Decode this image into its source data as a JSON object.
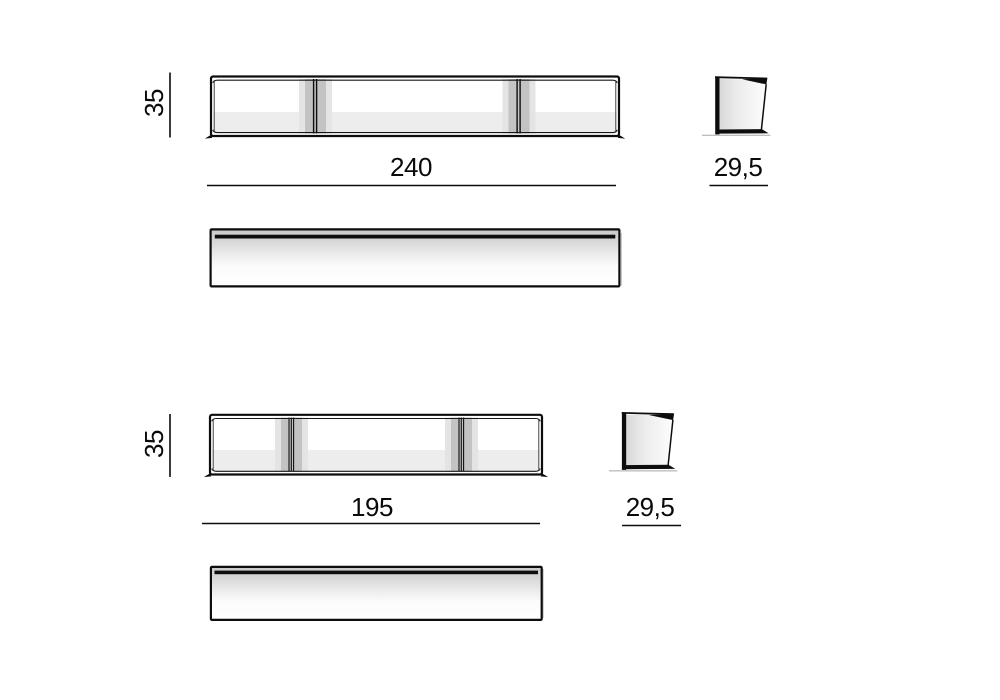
{
  "colors": {
    "background": "#ffffff",
    "line": "#0d0d0d",
    "interior_shade": "#ededed",
    "divider_light": "#e4e4e4",
    "divider_medium": "#c3c3c3"
  },
  "diagram": {
    "type": "furniture-dimension-drawing",
    "items": [
      {
        "name": "wall-unit-240",
        "views": [
          "front",
          "side",
          "top"
        ],
        "compartments": 3,
        "dimensions": {
          "height": "35",
          "width": "240",
          "depth": "29,5"
        }
      },
      {
        "name": "wall-unit-195",
        "views": [
          "front",
          "side",
          "top"
        ],
        "compartments": 3,
        "dimensions": {
          "height": "35",
          "width": "195",
          "depth": "29,5"
        }
      }
    ]
  }
}
